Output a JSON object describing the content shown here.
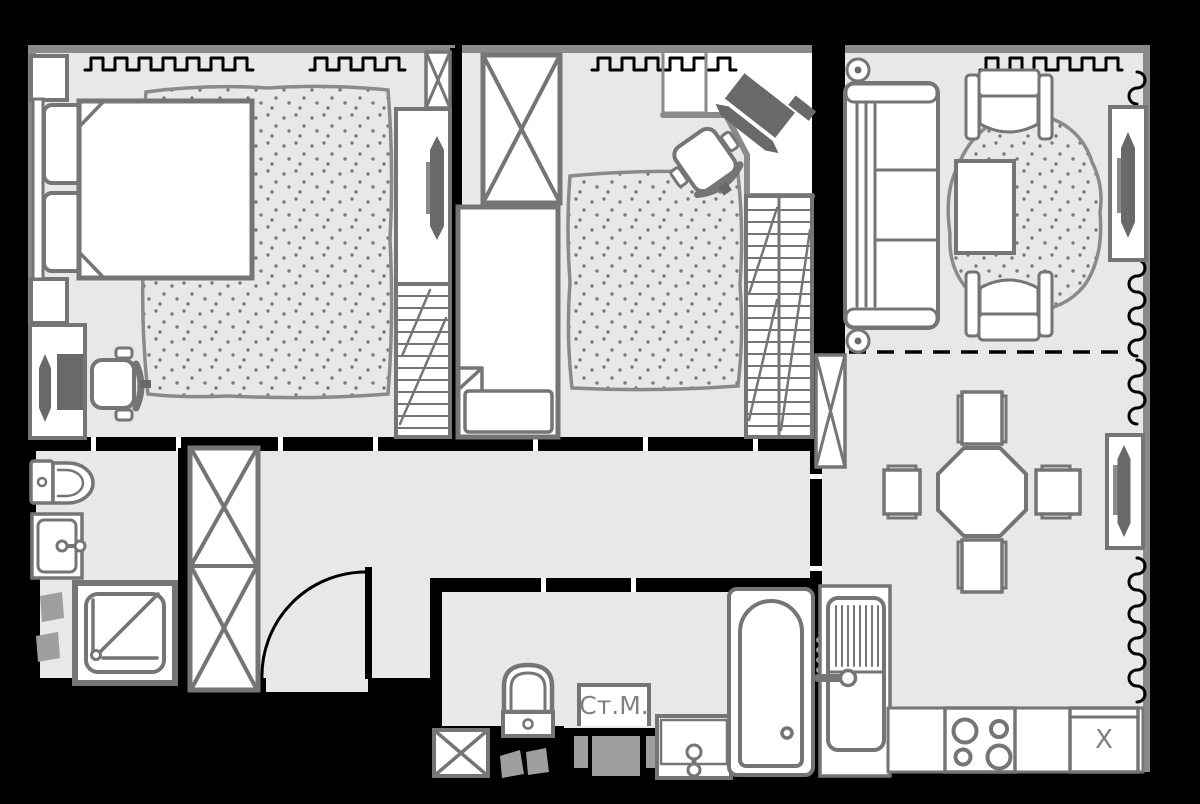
{
  "colors": {
    "background": "#000000",
    "floor": "#e8e8e8",
    "wall": "#000000",
    "exterior_wall": "#8a8a8a",
    "line": "#757575",
    "line_light": "#8a8a8a",
    "dark": "#696969",
    "soft_gray": "#9e9e9e",
    "label_text": "#808080",
    "fill_white": "#ffffff"
  },
  "labels": {
    "washing_machine": "Ст.М.",
    "fridge": "X"
  },
  "furniture_symbols": [
    "double-bed",
    "single-bed",
    "pillow",
    "dotted-rug",
    "round-rug",
    "wardrobe-crossed-box",
    "ventilation-shaft-crossed-box",
    "desk",
    "corner-desk",
    "office-chair",
    "monitor",
    "wardrobe-with-sliding-door",
    "shelf-rack",
    "sofa",
    "armchair",
    "coffee-table",
    "radiator",
    "dining-table-octagon",
    "stool",
    "kitchen-sink-cabinet",
    "stove-4-burners",
    "fridge",
    "kitchen-counter",
    "toilet",
    "washbasin",
    "shower-cabin",
    "bathtub",
    "washing-machine",
    "entrance-door-arc",
    "window-curtain-zigzag",
    "zone-divider-dashed",
    "slippers"
  ]
}
